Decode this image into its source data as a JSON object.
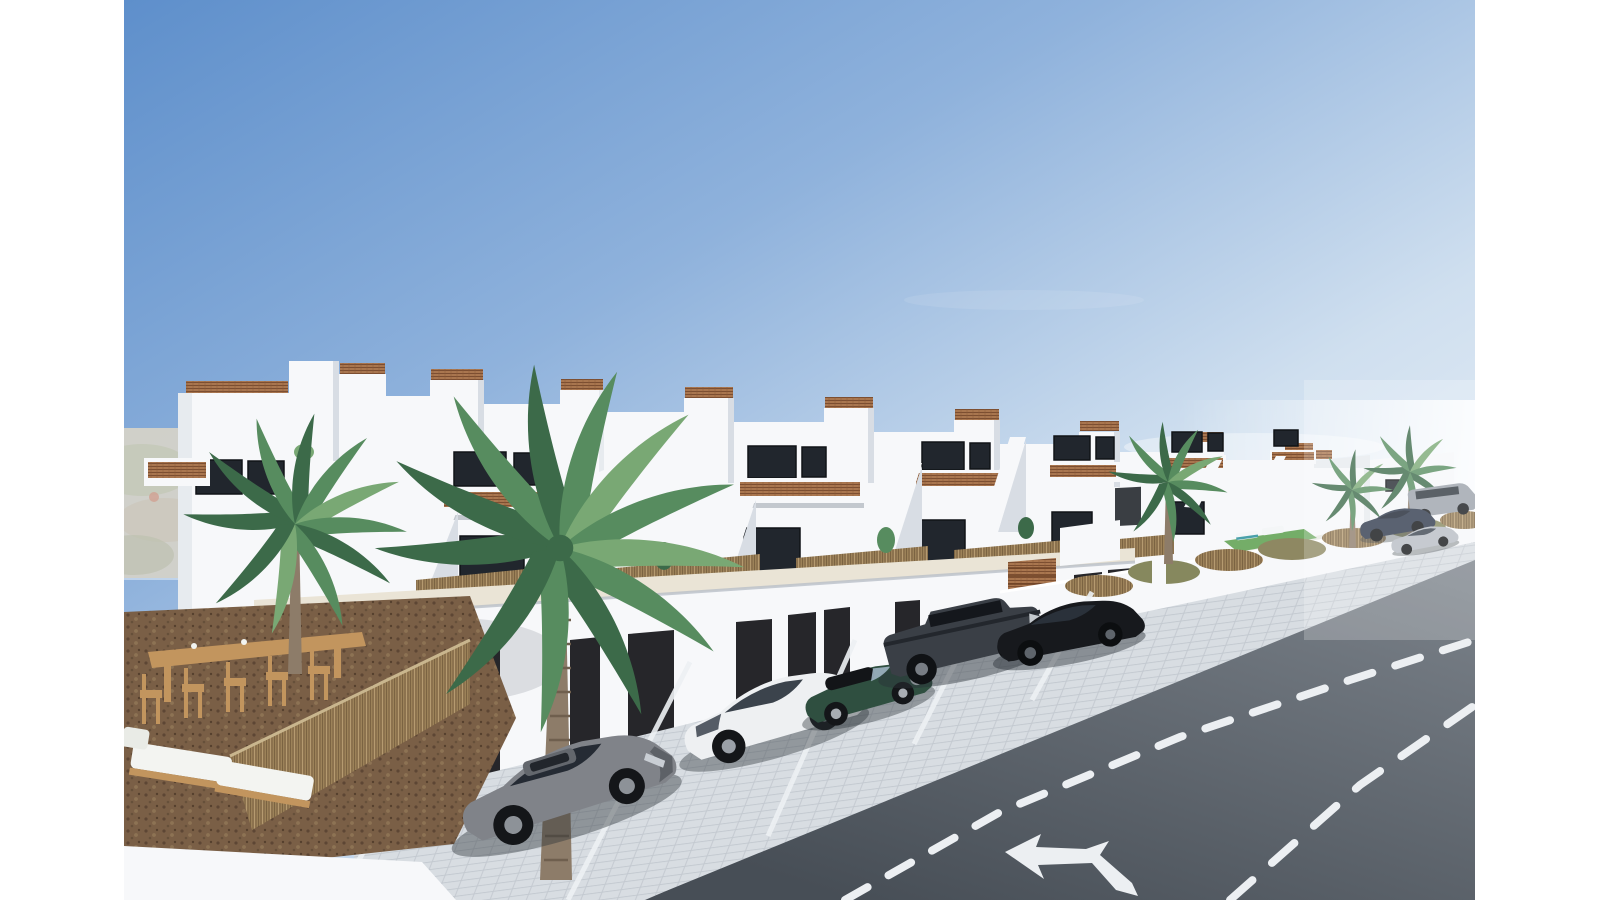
{
  "meta": {
    "type": "3d-architectural-exterior-render",
    "subject": "Row of new-build white two-storey terraced villas with roof terraces, cane railing accents, street-front garages, paved parking with cars, communal pool enclosure, palm trees and an asphalt road with lane markings",
    "visible_text": "none"
  },
  "palette": {
    "sky_top": "#5e8fcb",
    "sky_mid": "#8fb2dc",
    "sky_low": "#cfdfef",
    "sky_haze": "#eef3f9",
    "building_white": "#f7f8fa",
    "building_shade": "#e7ebef",
    "building_deep": "#d8dde4",
    "walkway_cream": "#eae4d6",
    "window_dark": "#21262d",
    "garage_door": "#26262a",
    "rattan": "#a9764f",
    "rattan_dark": "#7c4e31",
    "reed_tan": "#9c8259",
    "mulch_brown": "#7a5f46",
    "wood": "#c2955e",
    "paver_grey": "#d8dde2",
    "road_far": "#7e858d",
    "road_near": "#474e56",
    "road_marking": "#eceff2",
    "pool_water": "#9bd4de",
    "grass_green": "#74ad68",
    "palm_dark": "#3c6a49",
    "palm_mid": "#578c5f",
    "palm_light": "#79a874",
    "trunk": "#8d7c69",
    "hill_tan": "#b3ae9d",
    "car_grey": "#808389",
    "car_white": "#eef0f2",
    "car_green": "#2f4f40",
    "car_darkgrey": "#3a3f46",
    "car_black": "#17191d",
    "car_blue": "#2c3749",
    "car_silver": "#b6bcc3",
    "car_van": "#9aa1a9"
  },
  "scene": {
    "buildings": {
      "visible_units": 8,
      "storeys": 2,
      "features": [
        "stepped white parapets and stair towers",
        "roof terraces edged with cane/rattan railing panels",
        "balconies with cane balustrade inserts",
        "dark-framed glazing",
        "external white staircases to upper homes",
        "ground-floor terraces screened with natural reed fencing",
        "street-level garage row with dark doors",
        "timber slat entrance screen"
      ]
    },
    "pool_enclosure": {
      "pools": 1,
      "water_color": "#9bd4de",
      "sun_loungers": 2,
      "lawn_patch": true,
      "reed_hedge_on_wall": true
    },
    "vehicles": [
      {
        "name": "grey-sedan",
        "color": "#808389"
      },
      {
        "name": "white-hatchback",
        "color": "#eef0f2"
      },
      {
        "name": "green-convertible-mini",
        "color": "#2f4f40"
      },
      {
        "name": "dark-grey-boxy-suv",
        "color": "#3a3f46"
      },
      {
        "name": "black-suv-coupe",
        "color": "#17191d"
      },
      {
        "name": "parked-dark-blue-suv",
        "color": "#2c3749"
      },
      {
        "name": "parked-silver-sedan",
        "color": "#b6bcc3"
      },
      {
        "name": "parked-grey-van",
        "color": "#9aa1a9"
      }
    ],
    "road": {
      "surface": "asphalt",
      "markings": [
        "dashed lane line (centre)",
        "dashed lane line (right)",
        "white combined direction arrow"
      ]
    },
    "vegetation": {
      "palm_trees": 5,
      "ground_cover": "bark mulch",
      "screens": "natural reed"
    },
    "left_terrace": {
      "furniture": [
        "timber high bar table",
        "five timber bar stools",
        "two white cushioned sun loungers"
      ]
    }
  }
}
